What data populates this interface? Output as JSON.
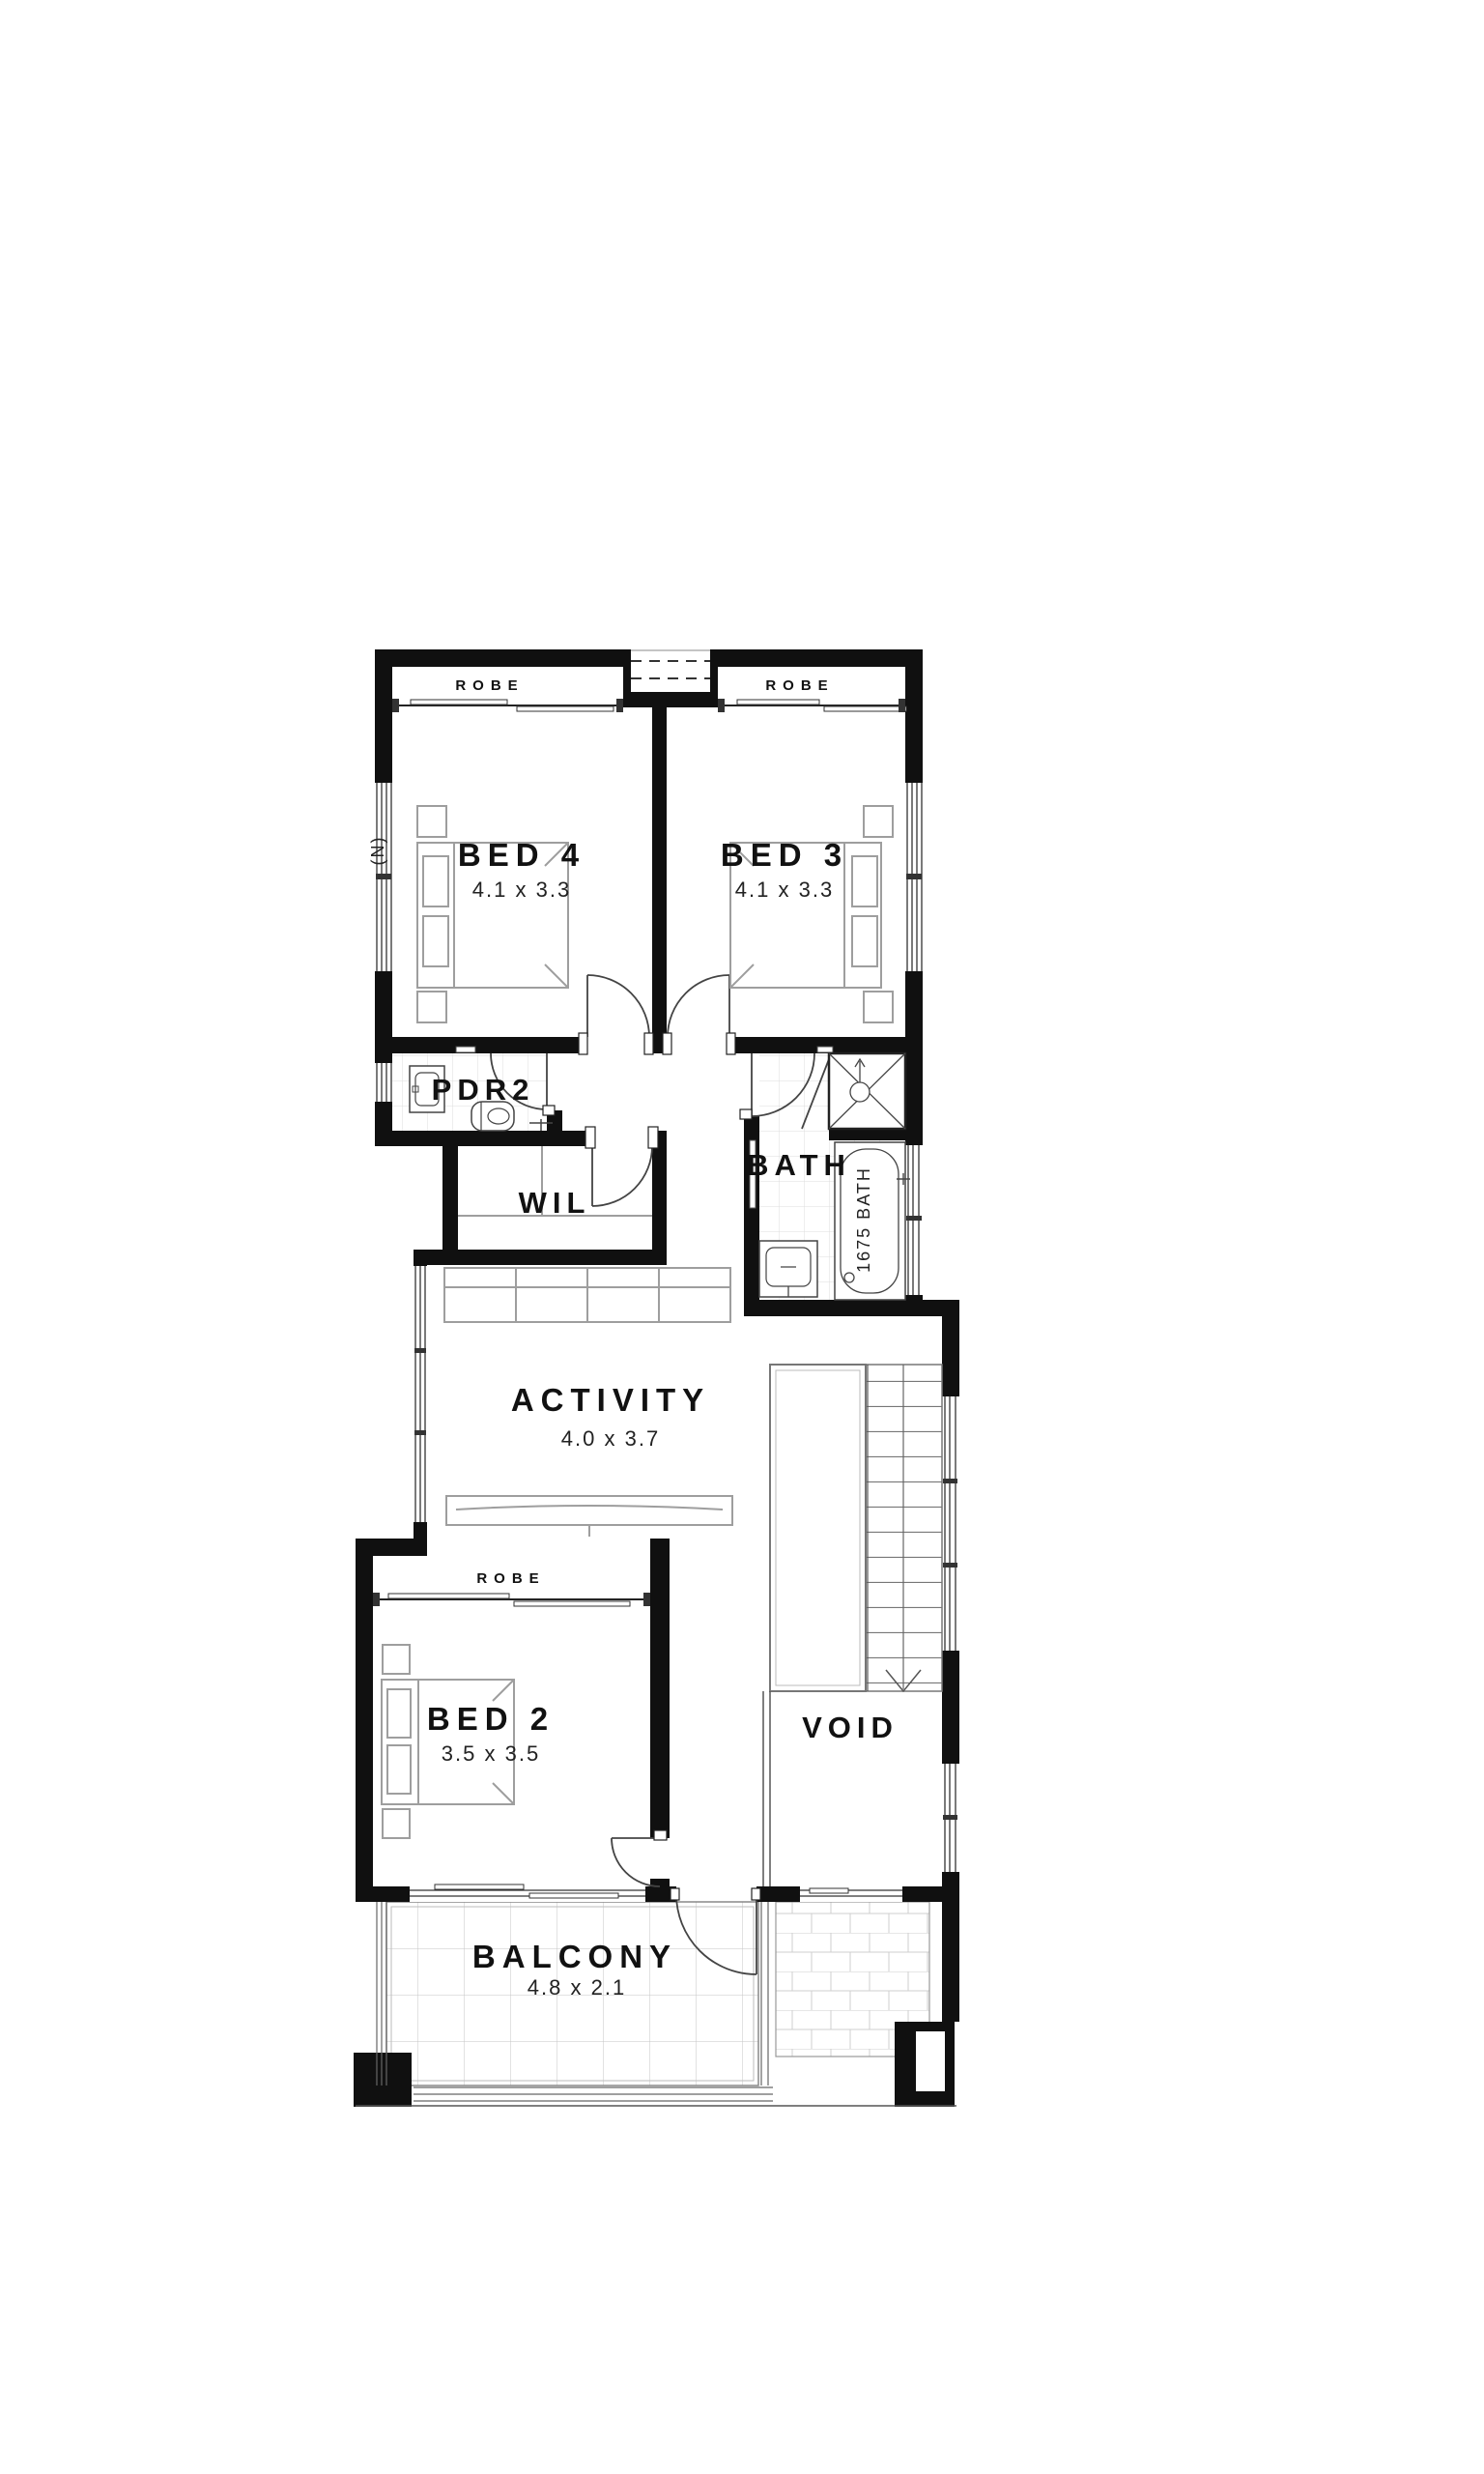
{
  "rooms": {
    "bed4": {
      "label": "BED 4",
      "dims": "4.1 x 3.3"
    },
    "bed3": {
      "label": "BED 3",
      "dims": "4.1 x 3.3"
    },
    "bed2": {
      "label": "BED 2",
      "dims": "3.5 x 3.5"
    },
    "activity": {
      "label": "ACTIVITY",
      "dims": "4.0 x 3.7"
    },
    "balcony": {
      "label": "BALCONY",
      "dims": "4.8 x 2.1"
    },
    "pdr2": {
      "label": "PDR2"
    },
    "wil": {
      "label": "WIL"
    },
    "bath": {
      "label": "BATH"
    },
    "void": {
      "label": "VOID"
    }
  },
  "robes": {
    "bed4": "ROBE",
    "bed3": "ROBE",
    "bed2": "ROBE"
  },
  "fixtures": {
    "bath_tub": "1675 BATH"
  },
  "compass": {
    "north": "(N)"
  },
  "colors": {
    "wall": "#101010",
    "door_line": "#444444",
    "tile_line": "#dddddd",
    "balcony_grid": "#c6c6c6",
    "furniture_line": "#9e9e9e",
    "text": "#111111",
    "background": "#ffffff"
  }
}
